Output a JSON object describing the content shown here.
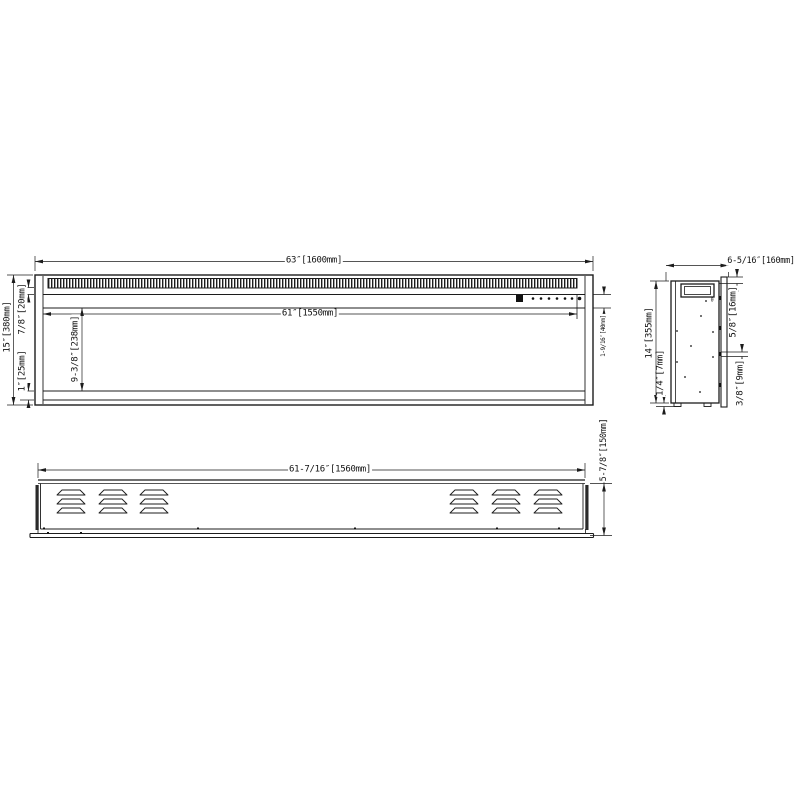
{
  "colors": {
    "line": "#1c1c1c",
    "background": "#ffffff",
    "fill_dark": "#111111"
  },
  "views": {
    "front": {
      "dim_overall_width": "63″[1600mm]",
      "dim_opening_width": "61″[1550mm]",
      "dim_overall_height": "15″[380mm]",
      "dim_top_frame": "7/8″[20mm]",
      "dim_opening_height": "9-3/8″[238mm]",
      "dim_bottom_frame": "1″[25mm]",
      "dim_control_strip": "1-9/16″[40mm]"
    },
    "side": {
      "dim_depth": "6-5/16″[160mm]",
      "dim_flange_offset": "5/8″[16mm]",
      "dim_height": "14″[355mm]",
      "dim_foot_gap": "1/4″[7mm]",
      "dim_tab": "3/8″[9mm]",
      "mark_zero": "0"
    },
    "bottom": {
      "dim_width": "61-7/16″[1560mm]",
      "dim_depth": "5-7/8″[150mm]"
    }
  }
}
